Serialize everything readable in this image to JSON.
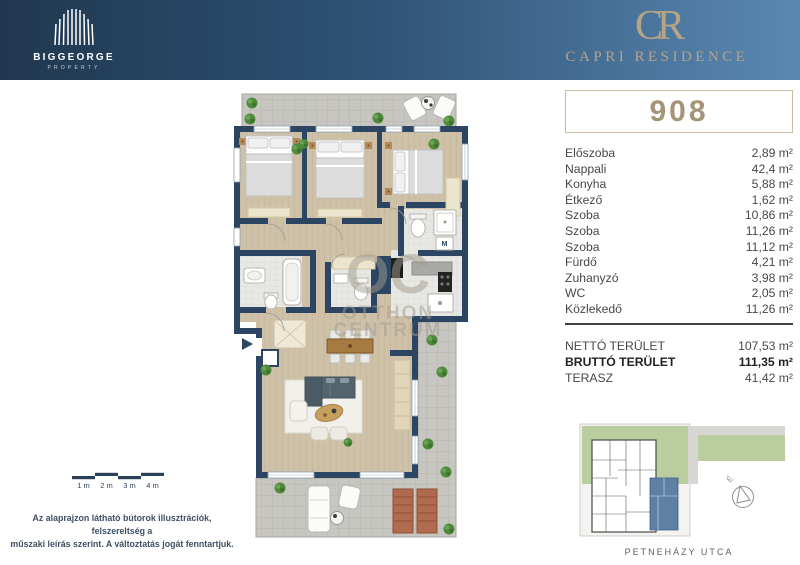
{
  "header": {
    "brand": {
      "name": "BIGGEORGE",
      "sub": "PROPERTY"
    },
    "logo": {
      "monogram": "CR",
      "name": "CAPRI RESIDENCE"
    },
    "colors": {
      "navy": "#20384f",
      "steel_blue": "#5a88b3",
      "gold": "#b7a485"
    }
  },
  "unit": {
    "number": "908"
  },
  "rooms": [
    {
      "label": "Előszoba",
      "area": "2,89 m²"
    },
    {
      "label": "Nappali",
      "area": "42,4 m²"
    },
    {
      "label": "Konyha",
      "area": "5,88 m²"
    },
    {
      "label": "Étkező",
      "area": "1,62 m²"
    },
    {
      "label": "Szoba",
      "area": "10,86 m²"
    },
    {
      "label": "Szoba",
      "area": "11,26 m²"
    },
    {
      "label": "Szoba",
      "area": "11,12 m²"
    },
    {
      "label": "Fürdő",
      "area": "4,21 m²"
    },
    {
      "label": "Zuhanyzó",
      "area": "3,98 m²"
    },
    {
      "label": "WC",
      "area": "2,05 m²"
    },
    {
      "label": "Közlekedő",
      "area": "11,26 m²"
    }
  ],
  "totals": [
    {
      "label": "NETTÓ TERÜLET",
      "area": "107,53 m²"
    },
    {
      "label": "BRUTTÓ TERÜLET",
      "area": "111,35 m²"
    },
    {
      "label": "TERASZ",
      "area": "41,42 m²"
    }
  ],
  "scalebar": {
    "labels": [
      "1 m",
      "2 m",
      "3 m",
      "4 m"
    ]
  },
  "disclaimer": {
    "line1": "Az alaprajzon látható bútorok illusztrációk, felszereltség a",
    "line2": "műszaki leírás szerint. A változtatás jogát fenntartjuk."
  },
  "siteplan": {
    "street": "PETNEHÁZY UTCA",
    "compass": "É",
    "colors": {
      "lawn": "#b9cd9f",
      "highlight_unit": "#5e80a4"
    }
  },
  "floorplan": {
    "washer_label": "M",
    "watermark": {
      "logo": "OC",
      "line1": "OTTHON",
      "line2": "CENTRUM"
    },
    "colors": {
      "wall": "#2b4563",
      "wood_floor": "#cfc1a7",
      "terrace_tile": "#c7c6c1"
    }
  }
}
